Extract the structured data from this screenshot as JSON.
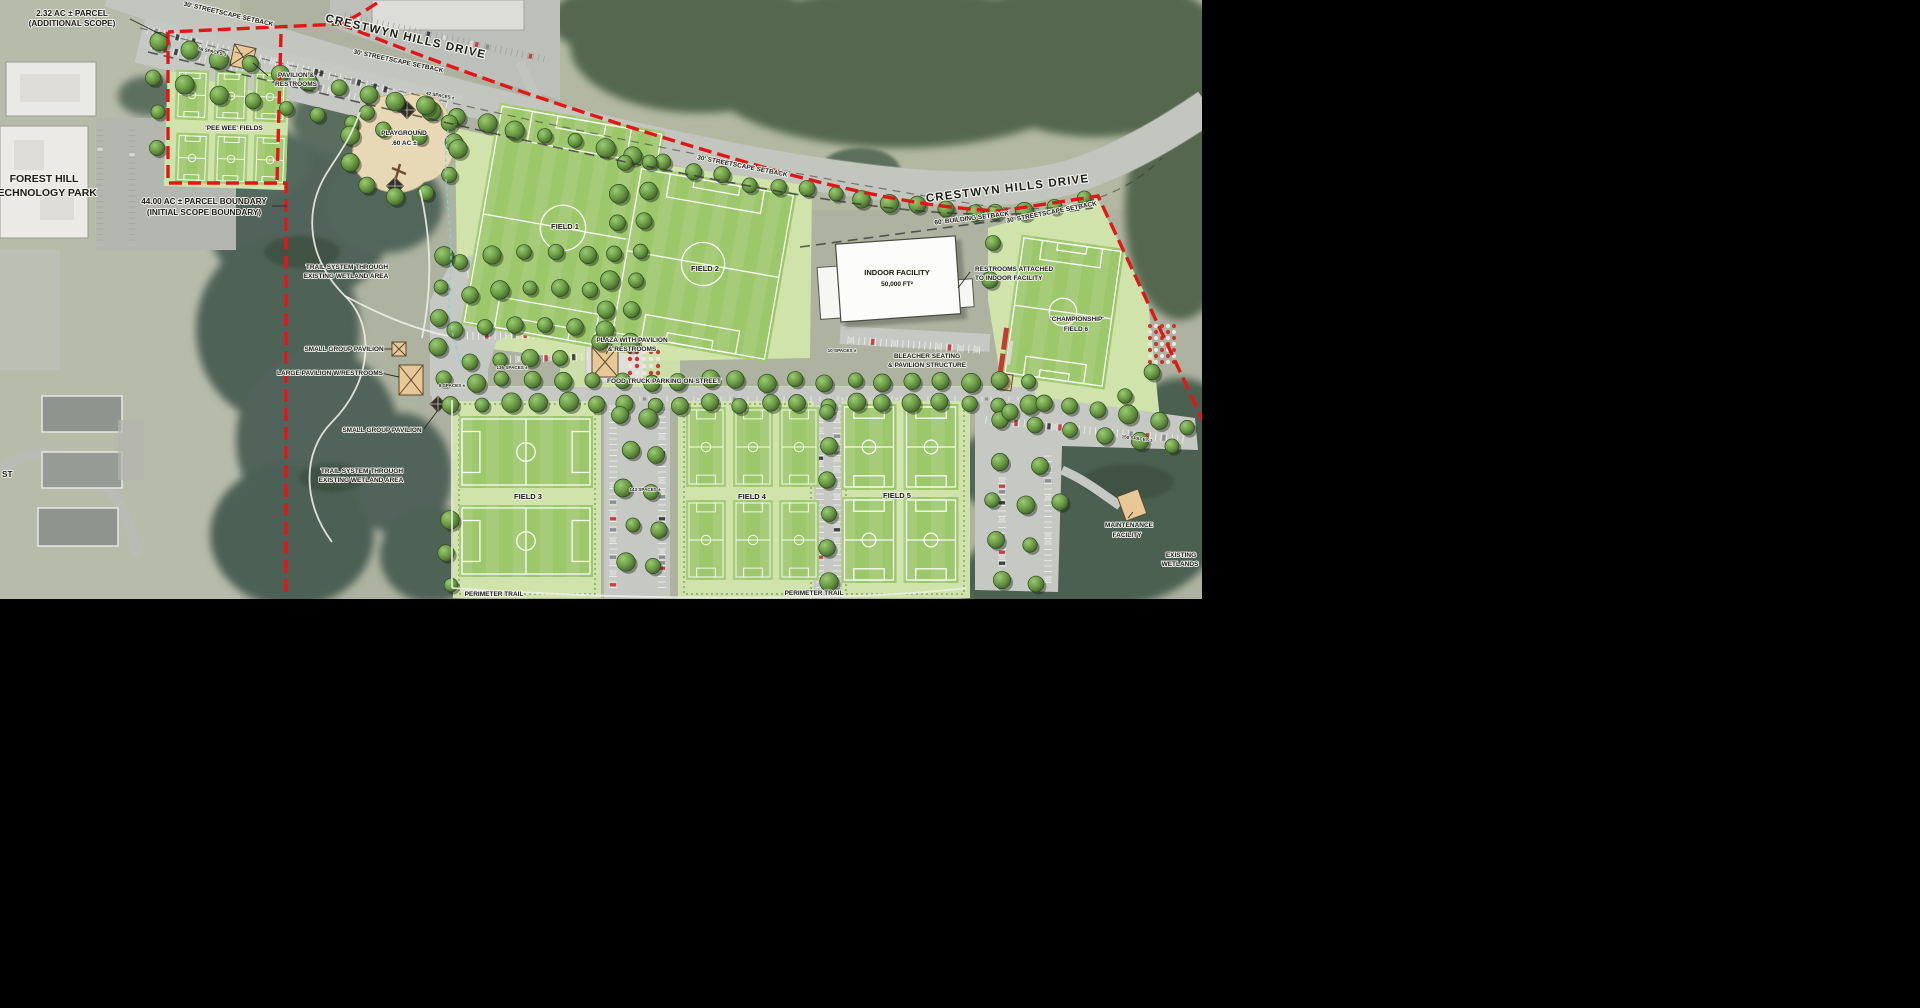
{
  "canvas": {
    "background": "#000000"
  },
  "map": {
    "width": 1202,
    "height": 599
  },
  "colors": {
    "boundary_red": "#e11717",
    "apron_green": "#cfe3ab",
    "field_green": "#9cc76a",
    "tree_green": "#6f9e4e",
    "road_gray": "#c9ccc7",
    "pavilion_tan": "#e9c897"
  },
  "labels": {
    "parcel_232": [
      "2.32 AC ± PARCEL",
      "(ADDITIONAL SCOPE)"
    ],
    "road_name": "CRESTWYN HILLS DRIVE",
    "streetscape": "30' STREETSCAPE SETBACK",
    "building_setback": "60' BUILDING SETBACK",
    "pavilion_restrooms": [
      "PAVILION &",
      "RESTROOMS"
    ],
    "pee_wee": "'PEE WEE' FIELDS",
    "forest_hill": [
      "FOREST HILL",
      "TECHNOLOGY PARK"
    ],
    "parcel_44": [
      "44.00 AC ± PARCEL BOUNDARY",
      "(INITIAL SCOPE BOUNDARY)"
    ],
    "playground": [
      "PLAYGROUND",
      ".60 AC ±"
    ],
    "spaces_58": "58 SPACES ±",
    "spaces_42": "42 SPACES ±",
    "spaces_136": "136 SPACES ±",
    "spaces_8": "8 SPACES ±",
    "spaces_143": "143 SPACES ±",
    "spaces_150": "150 SPACES ±",
    "spaces_10": "10 SPACES ±",
    "trail_system": [
      "TRAIL SYSTEM THROUGH",
      "EXISTING WETLAND AREA"
    ],
    "small_group_pavilion": "SMALL GROUP PAVILION",
    "large_pavilion": "LARGE PAVILION W/RESTROOMS",
    "plaza": [
      "PLAZA WITH PAVILION",
      "& RESTROOMS"
    ],
    "food_truck": "FOOD TRUCK PARKING ON-STREET",
    "field_1": "FIELD 1",
    "field_2": "FIELD 2",
    "field_3": "FIELD 3",
    "field_4": "FIELD 4",
    "field_5": "FIELD 5",
    "championship": [
      "'CHAMPIONSHIP'",
      "FIELD 6"
    ],
    "indoor_facility": [
      "INDOOR FACILITY",
      "50,000 FT²"
    ],
    "restrooms_attached": [
      "RESTROOMS ATTACHED",
      "TO INDOOR FACILITY"
    ],
    "bleacher": [
      "BLEACHER SEATING",
      "& PAVILION STRUCTURE"
    ],
    "maintenance": [
      "MAINTENANCE",
      "FACILITY"
    ],
    "existing_wetlands": [
      "EXISTING",
      "WETLANDS"
    ],
    "perimeter_trail": "PERIMETER TRAIL",
    "street_stub": "ST"
  }
}
